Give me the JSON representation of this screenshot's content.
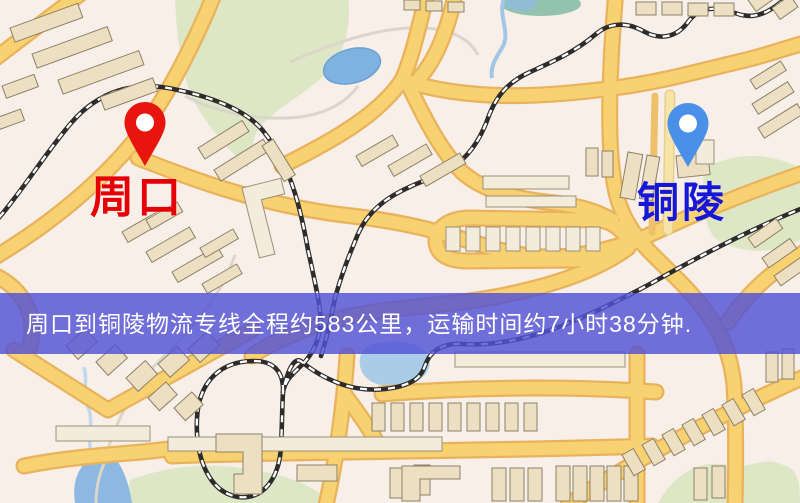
{
  "banner": {
    "text": "周口到铜陵物流专线全程约583公里，运输时间约7小时38分钟.",
    "distance": "约583公里",
    "duration": "约7小时38分钟",
    "background_color": "#5252d5",
    "text_color": "#ffffff"
  },
  "markers": [
    {
      "id": "origin",
      "label": "周口",
      "pin_color": "#e8150f",
      "label_color": "#e60005"
    },
    {
      "id": "destination",
      "label": "铜陵",
      "pin_color": "#4a8fe8",
      "label_color": "#1717d8"
    }
  ],
  "map_palette": {
    "background": "#f7efe8",
    "road_fill": "#f8d170",
    "road_border": "#e9b25c",
    "road_minor": "#f6e3a6",
    "park_green": "#dde7c6",
    "water_blue": "#8cb8e2",
    "building_tan": "#ecdfc2",
    "building_light": "#f3ecdb",
    "railway_dark": "#2e2c2a",
    "railway_dash": "#ffffff"
  }
}
